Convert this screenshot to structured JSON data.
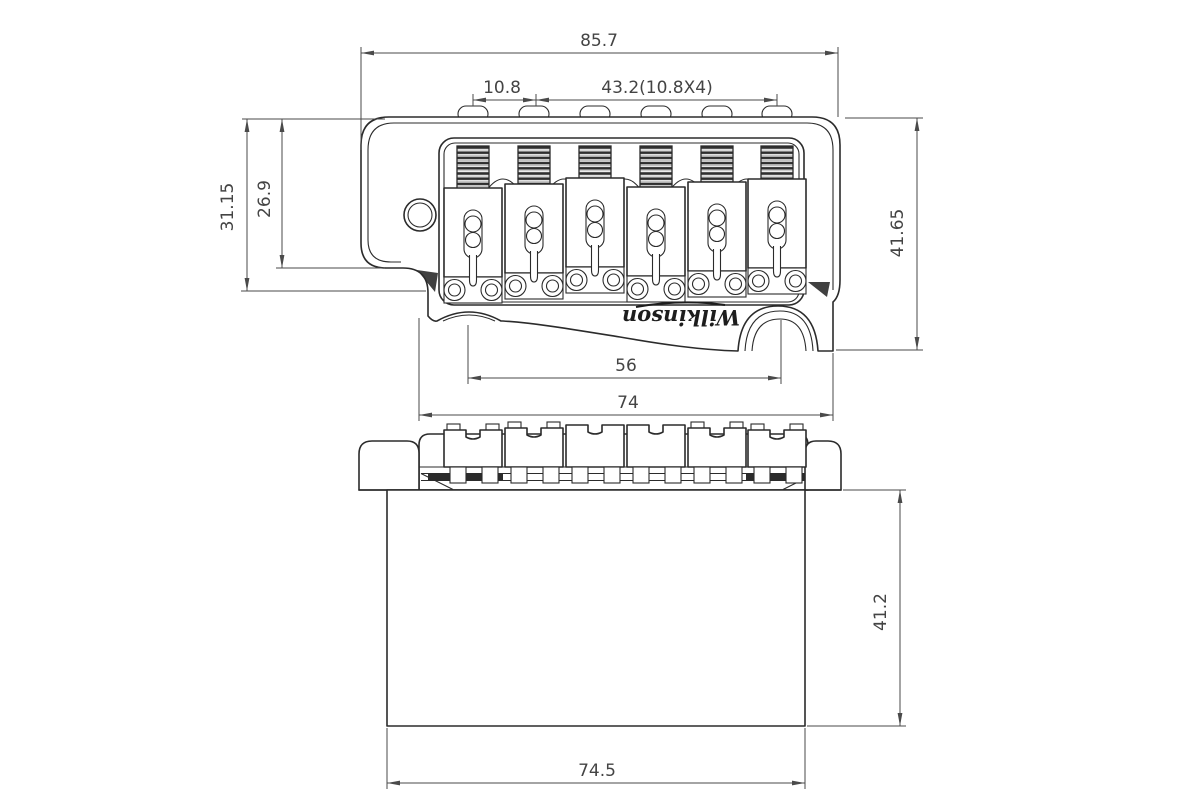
{
  "drawing": {
    "type": "technical-drawing",
    "subject": "tremolo-bridge",
    "background": "#ffffff",
    "object_line_color": "#2b2b2b",
    "dimension_color": "#4a4a4a"
  },
  "logo": {
    "text": "Wilkinson"
  },
  "dimensions": {
    "overall_width": "85.7",
    "saddle_pitch": "10.8",
    "saddle_span": "43.2(10.8X4)",
    "left_outer_depth": "31.15",
    "left_inner_depth": "26.9",
    "right_depth": "41.65",
    "mount_span": "56",
    "plate_width": "74",
    "block_height": "41.2",
    "block_width": "74.5"
  }
}
